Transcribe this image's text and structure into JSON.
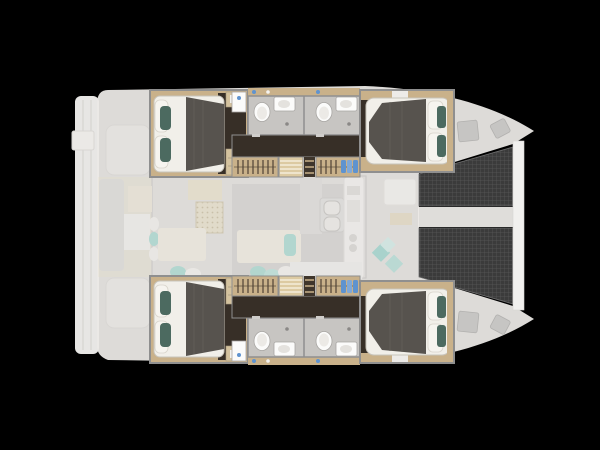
{
  "app": {
    "name": "Catamaran four-cabin layout plan",
    "description": "Top view yacht floor plan on black background, bow pointing right"
  },
  "canvas": {
    "width": 600,
    "height": 450
  },
  "colors": {
    "background": "#000000",
    "deck": "#ebe9e6",
    "deck_bright": "#f3f2f0",
    "deck_shade": "#cfcecc",
    "wall": "#8f8f8f",
    "wood": "#c9b18a",
    "wood_light": "#d4c29e",
    "steps": "#dccaa2",
    "floor_dark": "#372f27",
    "bed_white": "#f1efe9",
    "bed_blanket": "#57534e",
    "pillow_teal": "#4c6a60",
    "pillow_aqua": "#8fd3c9",
    "bath_floor": "#c7c5c2",
    "fixture_white": "#fbfbfa",
    "fixture_stroke": "#a8a6a3",
    "trampoline": "#3b3b3b",
    "trampoline_grid": "#575757",
    "beam": "#f1f0ee",
    "saloon_beige": "#e7ddc2",
    "sofa": "#f0ebdd",
    "hatch": "#c6c5c3",
    "blue_item": "#5f93cf"
  },
  "layout": {
    "orientation": "bow-right",
    "hulls": [
      "port (top)",
      "starboard (bottom)"
    ],
    "counts": {
      "double_cabins": 4,
      "bathrooms": 4,
      "trampoline_nets": 2,
      "companionways": 2,
      "swim_platforms": 1
    },
    "areas": [
      {
        "id": "swim-platform",
        "label": "Stern swim platform with steps"
      },
      {
        "id": "aft-cockpit",
        "label": "Aft cockpit with bench seating and teal cushions"
      },
      {
        "id": "saloon",
        "label": "Saloon with rattan table, sofas and chart seat"
      },
      {
        "id": "galley",
        "label": "Galley with twin round sinks and long counter"
      },
      {
        "id": "port-aft-cabin",
        "label": "Port aft double cabin, grey duvet, teal pillows"
      },
      {
        "id": "port-bathrooms",
        "label": "Two port en-suite bathrooms with toilet, basin and shower"
      },
      {
        "id": "port-corridor",
        "label": "Port corridor with wardrobes and companionway steps"
      },
      {
        "id": "port-fore-cabin",
        "label": "Port forward double cabin"
      },
      {
        "id": "starboard-aft-cabin",
        "label": "Starboard aft double cabin"
      },
      {
        "id": "starboard-bathrooms",
        "label": "Two starboard en-suite bathrooms"
      },
      {
        "id": "starboard-corridor",
        "label": "Starboard corridor with wardrobes and companionway steps"
      },
      {
        "id": "starboard-fore-cabin",
        "label": "Starboard forward double cabin"
      },
      {
        "id": "foredeck",
        "label": "Foredeck with sunpads, teal cushions and deck hatches"
      },
      {
        "id": "trampolines",
        "label": "Twin bow trampoline nets"
      },
      {
        "id": "forward-beam",
        "label": "Forward crossbeam between bows"
      }
    ]
  }
}
